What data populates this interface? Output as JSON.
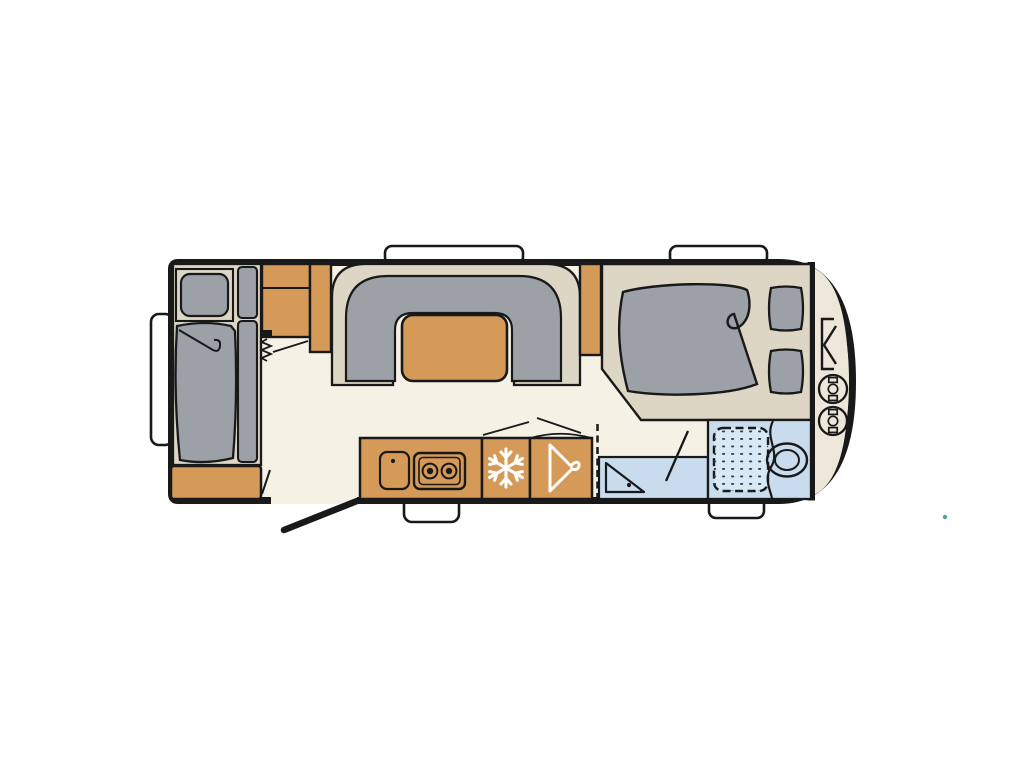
{
  "canvas": {
    "width": 1024,
    "height": 768,
    "background": "#ffffff"
  },
  "palette": {
    "ink": "#191919",
    "floor_cream": "#f6f1e5",
    "furniture_beige": "#ddd6c5",
    "locker_beige": "#ece7d9",
    "wood_orange": "#d59a57",
    "upholstery_gray": "#9ca1a8",
    "wetroom_blue": "#c8dcee",
    "shower_tray_blue": "#d9e8f5",
    "shower_dot": "#35404d",
    "window_white": "#ffffff",
    "artifact_teal": "#53a39b"
  },
  "floorplan": {
    "type": "caravan-floor-plan",
    "orientation": "rear-left_front-right",
    "windows": {
      "top": 2,
      "bottom": 2,
      "rear": 1
    },
    "rooms": [
      {
        "name": "rear-lounge",
        "furniture": [
          "single-bed",
          "pillow",
          "side-cushions",
          "storage-chest",
          "overhead-cabinets",
          "folding-partition"
        ]
      },
      {
        "name": "dinette",
        "furniture": [
          "u-shaped-seat-base",
          "u-shaped-cushion",
          "table"
        ]
      },
      {
        "name": "kitchen",
        "furniture": [
          "worktop",
          "sink",
          "two-burner-hob",
          "refrigerator",
          "wardrobe"
        ]
      },
      {
        "name": "washroom",
        "furniture": [
          "corner-basin",
          "shower-tray",
          "toilet",
          "sliding-door",
          "hinged-door"
        ]
      },
      {
        "name": "front-bedroom",
        "furniture": [
          "double-bed",
          "duvet",
          "pillow-left",
          "pillow-right"
        ]
      },
      {
        "name": "gas-locker",
        "furniture": [
          "locker-hatch",
          "gas-bottle",
          "gas-bottle"
        ]
      }
    ],
    "icons": [
      "snowflake-icon",
      "hanger-icon",
      "gas-bottle-icon",
      "spring-hinge-icon",
      "locker-hatch-icon"
    ],
    "openings": [
      "entry-door-open-leaf",
      "door-swing-line",
      "bathroom-door-swing-line",
      "folding-partition-line"
    ]
  }
}
